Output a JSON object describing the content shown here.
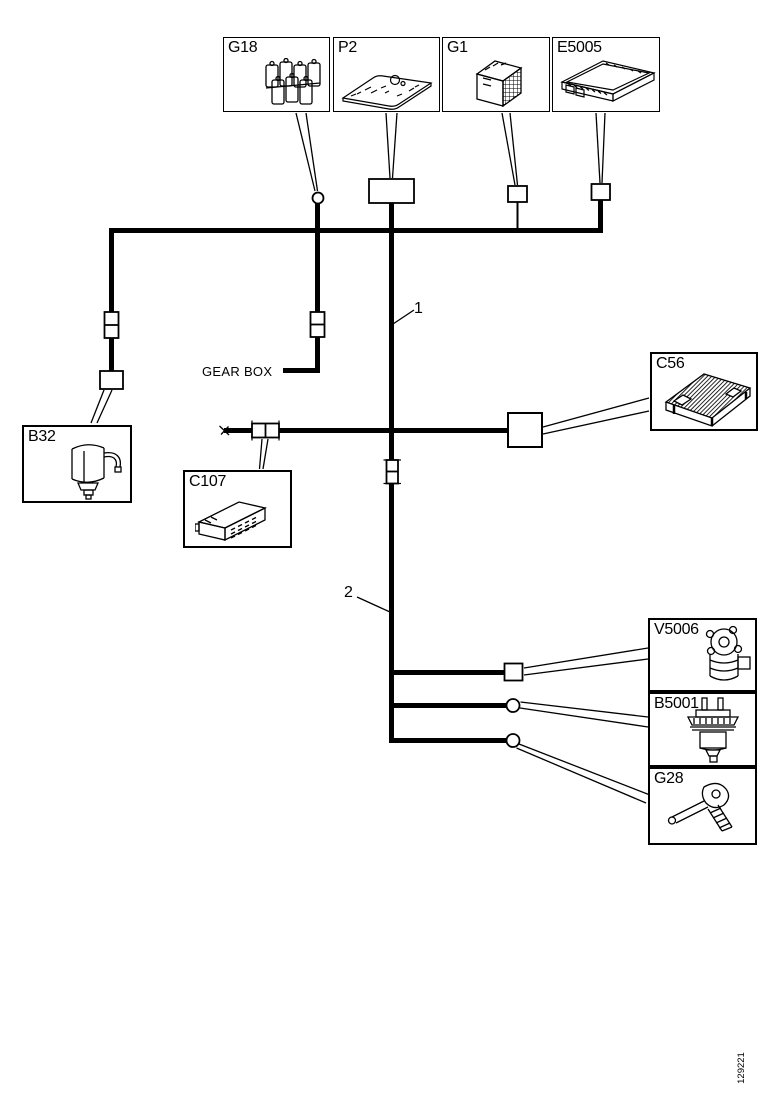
{
  "diagram": {
    "components": {
      "g18": {
        "label": "G18"
      },
      "p2": {
        "label": "P2"
      },
      "g1": {
        "label": "G1"
      },
      "e5005": {
        "label": "E5005"
      },
      "c56": {
        "label": "C56"
      },
      "b32": {
        "label": "B32"
      },
      "c107": {
        "label": "C107"
      },
      "v5006": {
        "label": "V5006"
      },
      "b5001": {
        "label": "B5001"
      },
      "g28": {
        "label": "G28"
      }
    },
    "annotations": {
      "gearbox_label": "GEAR BOX",
      "wire1_label": "1",
      "wire2_label": "2"
    },
    "footer": {
      "code": "129221"
    },
    "colors": {
      "line": "#000000",
      "background": "#ffffff"
    }
  }
}
